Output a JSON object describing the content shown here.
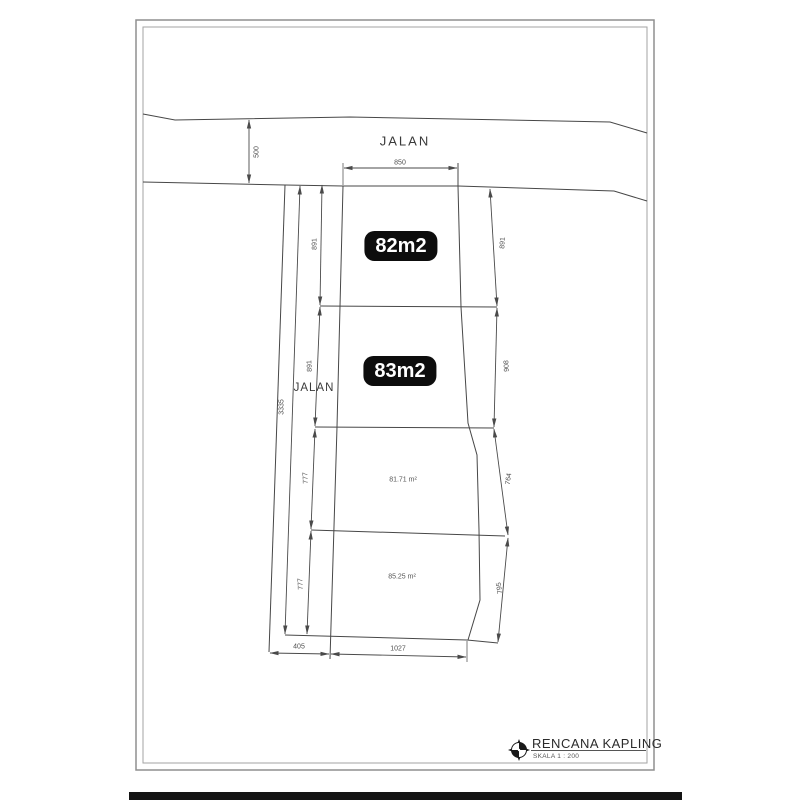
{
  "drawing": {
    "roads": {
      "top_label": "JALAN",
      "left_label": "JALAN"
    },
    "plots": [
      {
        "label": "82m2"
      },
      {
        "label": "83m2"
      },
      {
        "label": "81.71 m²"
      },
      {
        "label": "85.25 m²"
      }
    ],
    "dimensions": {
      "road_depth": "500",
      "top_width": "850",
      "left_chain": [
        "891",
        "891",
        "777",
        "777"
      ],
      "right_chain": [
        "891",
        "908",
        "764",
        "795"
      ],
      "overall_height": "3335",
      "bottom_left": "405",
      "bottom_width": "1027"
    },
    "title_block": {
      "title": "RENCANA KAPLING",
      "scale": "SKALA 1 : 200"
    }
  }
}
